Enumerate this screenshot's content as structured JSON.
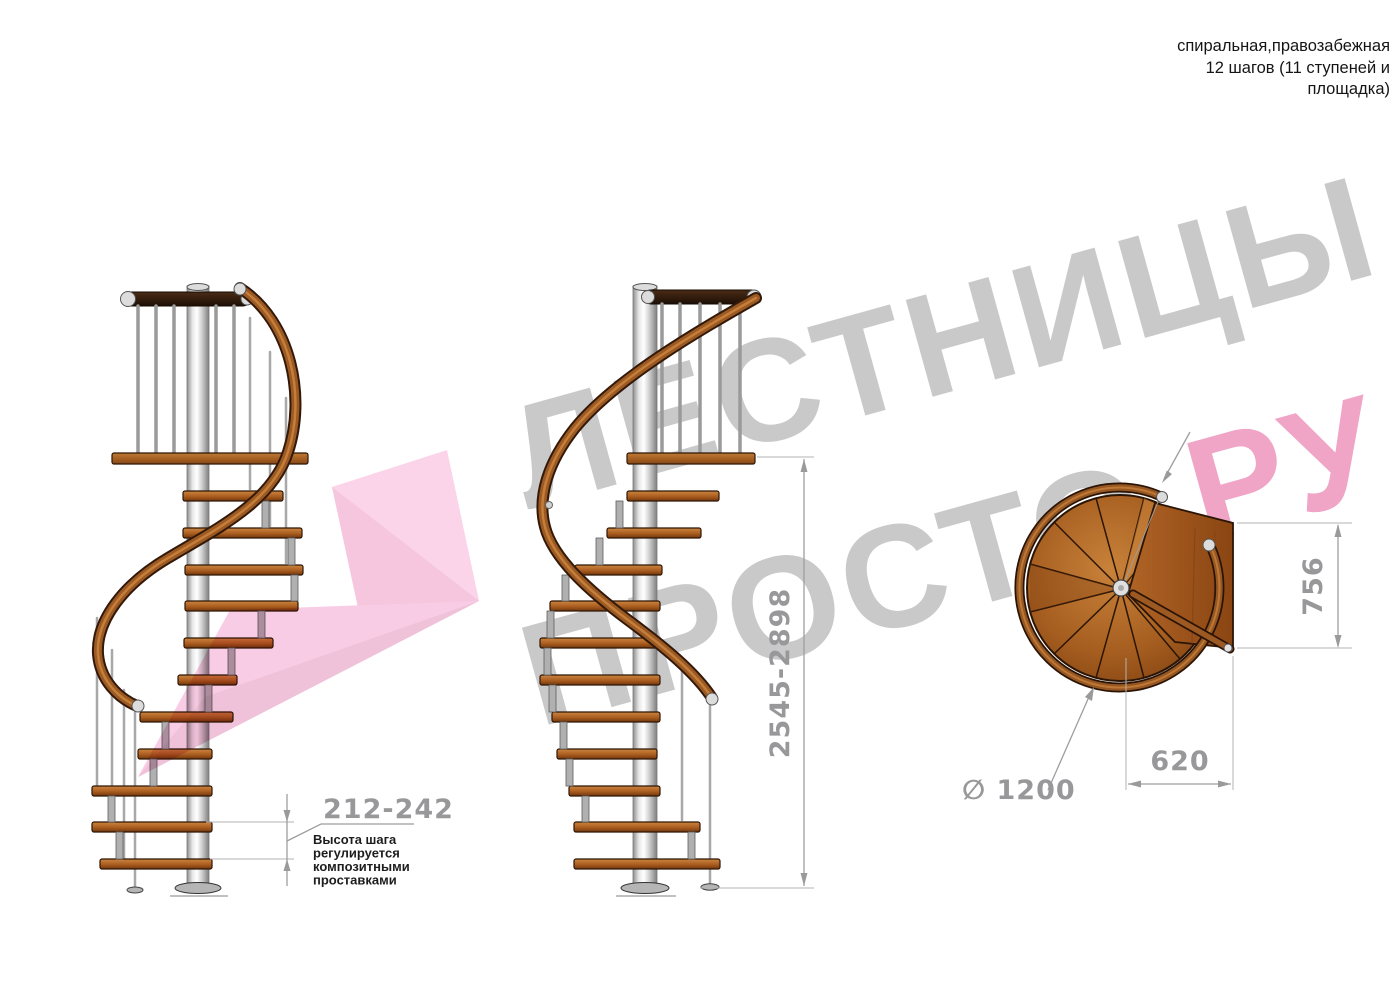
{
  "title_block": {
    "lines": [
      "спиральная,правозабежная",
      "12 шагов (11 ступеней и",
      "площадка)"
    ]
  },
  "watermark": {
    "line1": "ЛЕСТНИЦЫ",
    "line2_gray": "ПРОСТО",
    "line2_pink": ".РУ"
  },
  "dimensions": {
    "step_height": "212-242",
    "step_height_note": [
      "Высота шага",
      "регулируется",
      "композитными",
      "проставками"
    ],
    "total_height": "2545-2898",
    "platform_depth": "756",
    "pole_to_edge": "620",
    "diameter": "∅ 1200"
  },
  "colors": {
    "dimension_gray": "#98989a",
    "watermark_gray": "#c9c9c9",
    "watermark_pink": "#f0a4c6",
    "arrow_pink": "#f8cce4",
    "wood": "#a85c1e",
    "dark_wood": "#33190a",
    "metal": "#c9c9c9"
  }
}
